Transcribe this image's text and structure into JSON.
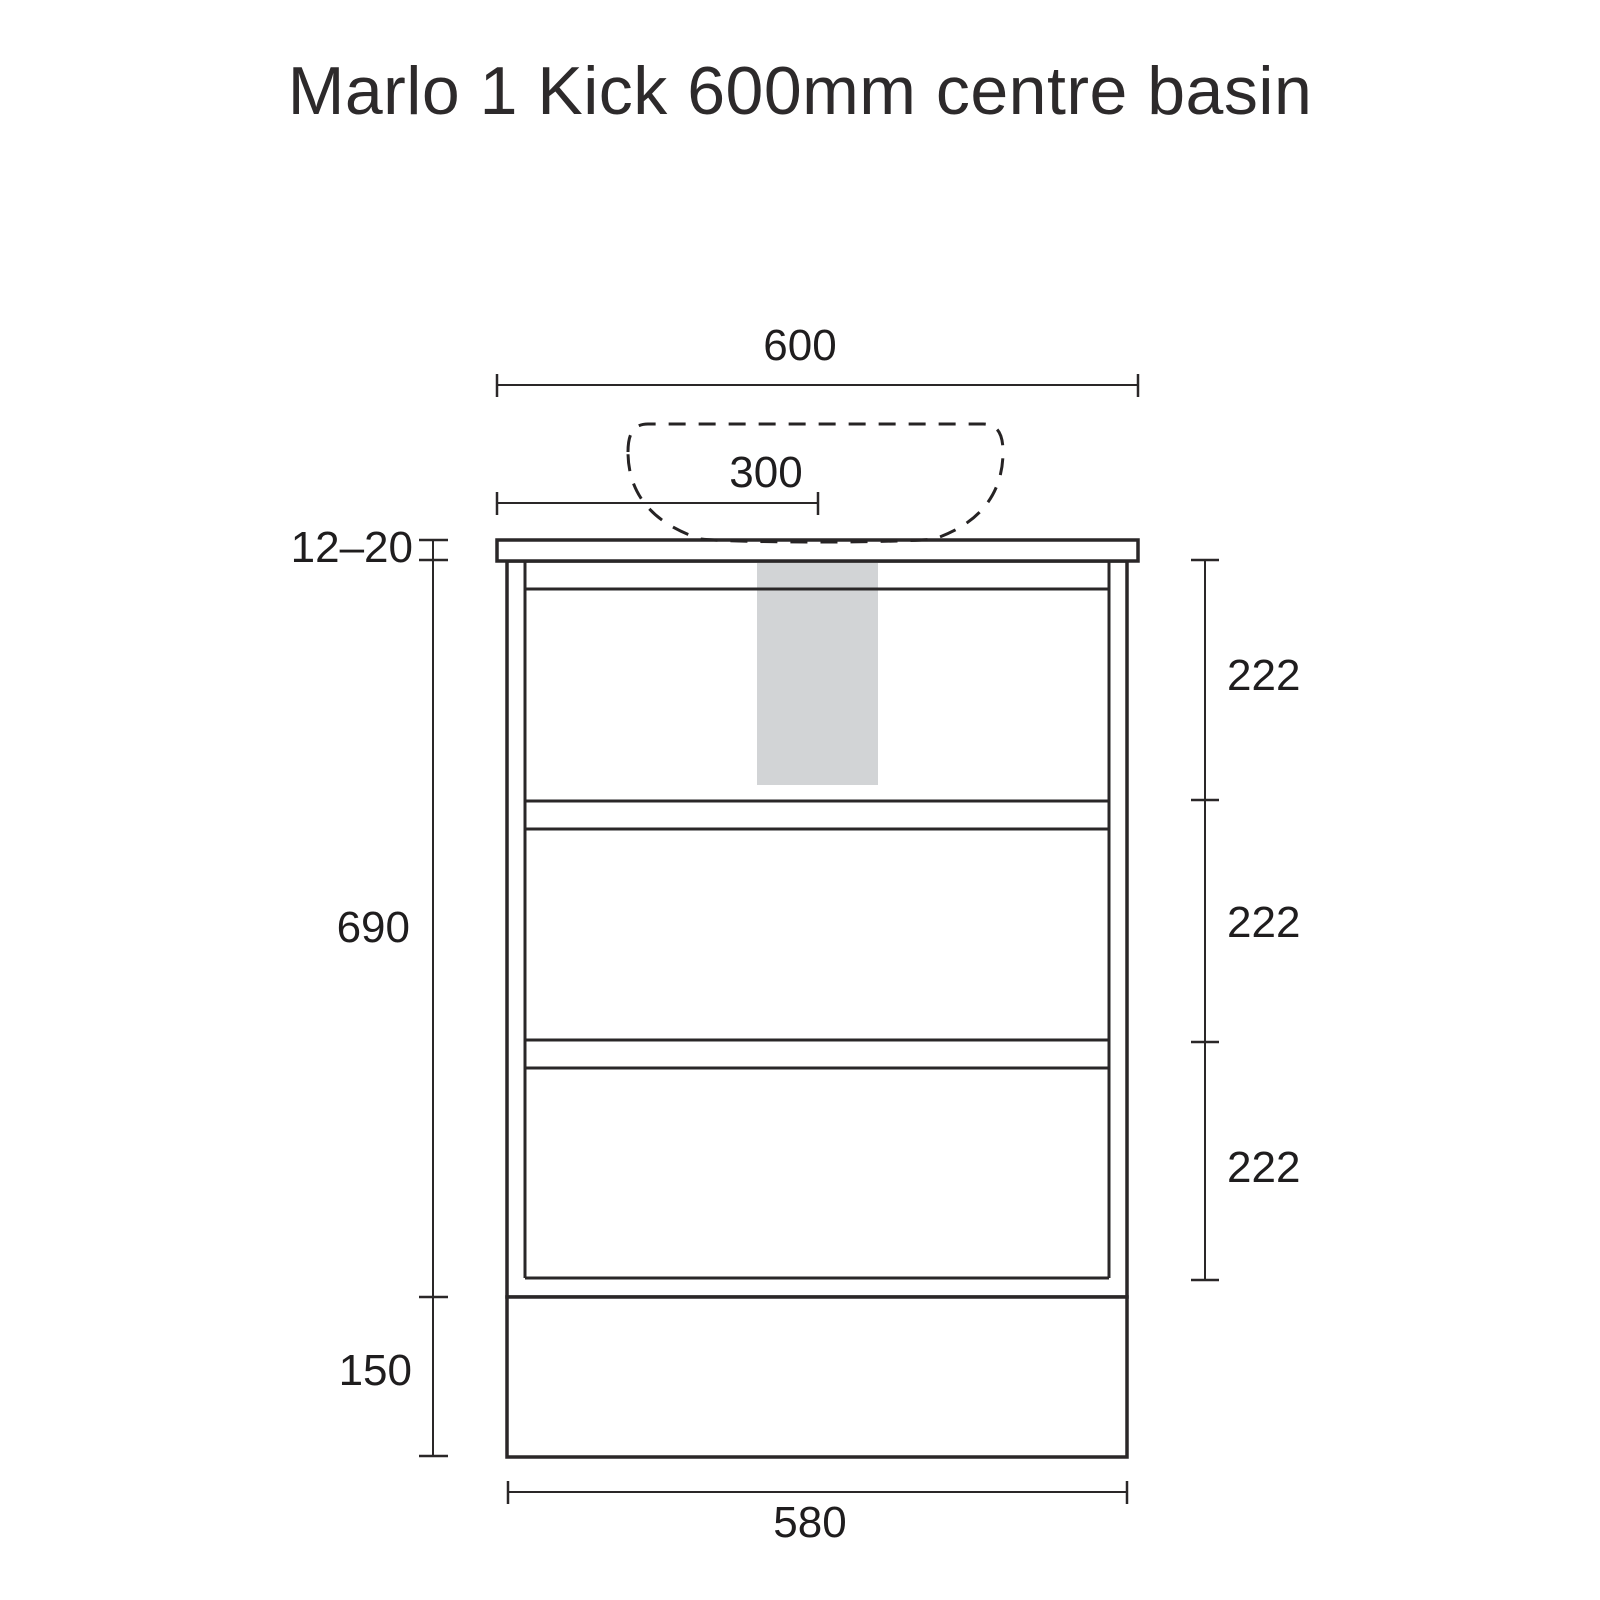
{
  "title": "Marlo 1 Kick 600mm centre basin",
  "drawing": {
    "type": "technical-elevation",
    "subject": "vanity cabinet with kick and counter-top basin",
    "units": "mm"
  },
  "dimensions": {
    "overall_width": "600",
    "basin_centre_offset": "300",
    "top_thickness_range": "12–20",
    "body_height": "690",
    "kick_height": "150",
    "kick_width": "580",
    "drawer_1_height": "222",
    "drawer_2_height": "222",
    "drawer_3_height": "222"
  },
  "colors": {
    "background": "#ffffff",
    "line": "#2a2728",
    "text": "#2b2829",
    "plumbing_zone_fill": "#d2d4d6"
  }
}
